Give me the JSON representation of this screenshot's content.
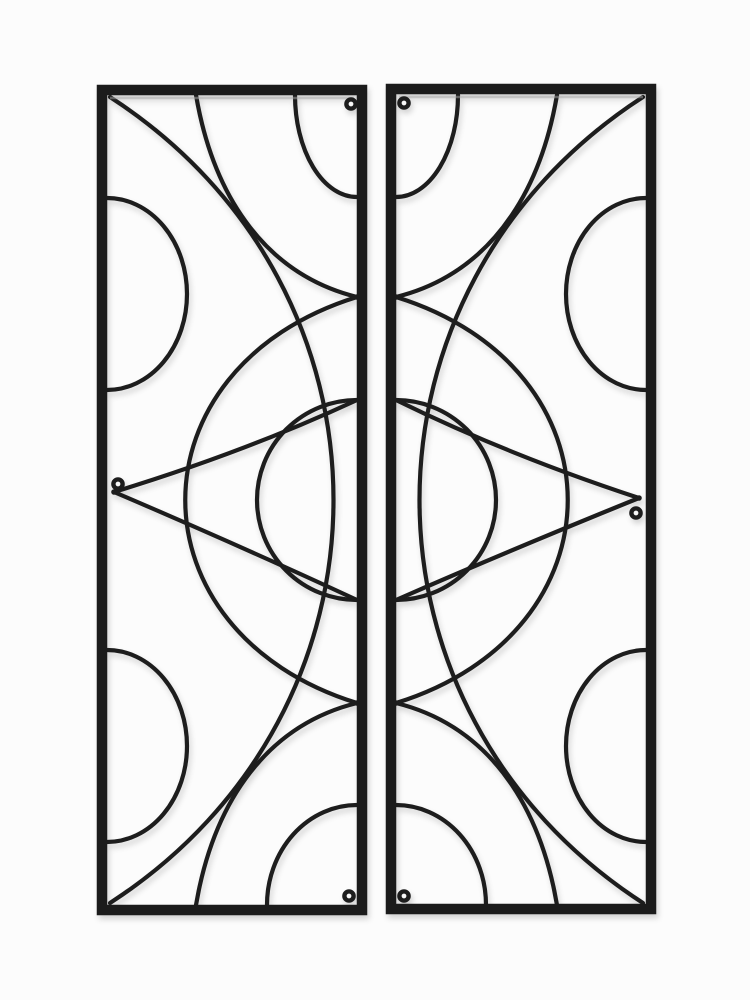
{
  "scene": {
    "subject": "Pair of tall rectangular black metal wall decor panels with wrought-iron circle and arc scrollwork on a white studio background",
    "panel_count": 2,
    "text_content": ""
  },
  "colors": {
    "background": "#fcfcfc",
    "frame": "#1b1b1b",
    "wire": "#1d1d1d",
    "frame_sheen": "#a8a8a8",
    "eyelet_hole": "#f7f7f7"
  },
  "panels": [
    {
      "id": "left-panel",
      "shape": "vertical rectangle",
      "motifs": [
        "top-right quarter arc",
        "bottom-right quarter arc",
        "left-edge upper half circle",
        "left-edge lower half circle",
        "central half circle on inner edge",
        "two diagonal strands",
        "large right-bulge sweep arc",
        "large left-bulge sweep arc",
        "leaf tip vertex on left edge"
      ],
      "eyelet_positions": [
        "top-right",
        "middle-left",
        "bottom-right"
      ]
    },
    {
      "id": "right-panel",
      "shape": "vertical rectangle",
      "motifs": [
        "top-left quarter arc",
        "bottom-left quarter arc",
        "right-edge upper half circle",
        "right-edge lower half circle",
        "central half circle on inner edge",
        "two diagonal strands",
        "large left-bulge sweep arc",
        "large right-bulge sweep arc",
        "leaf tip vertex on right edge"
      ],
      "eyelet_positions": [
        "top-left",
        "middle-right",
        "bottom-left"
      ]
    }
  ]
}
